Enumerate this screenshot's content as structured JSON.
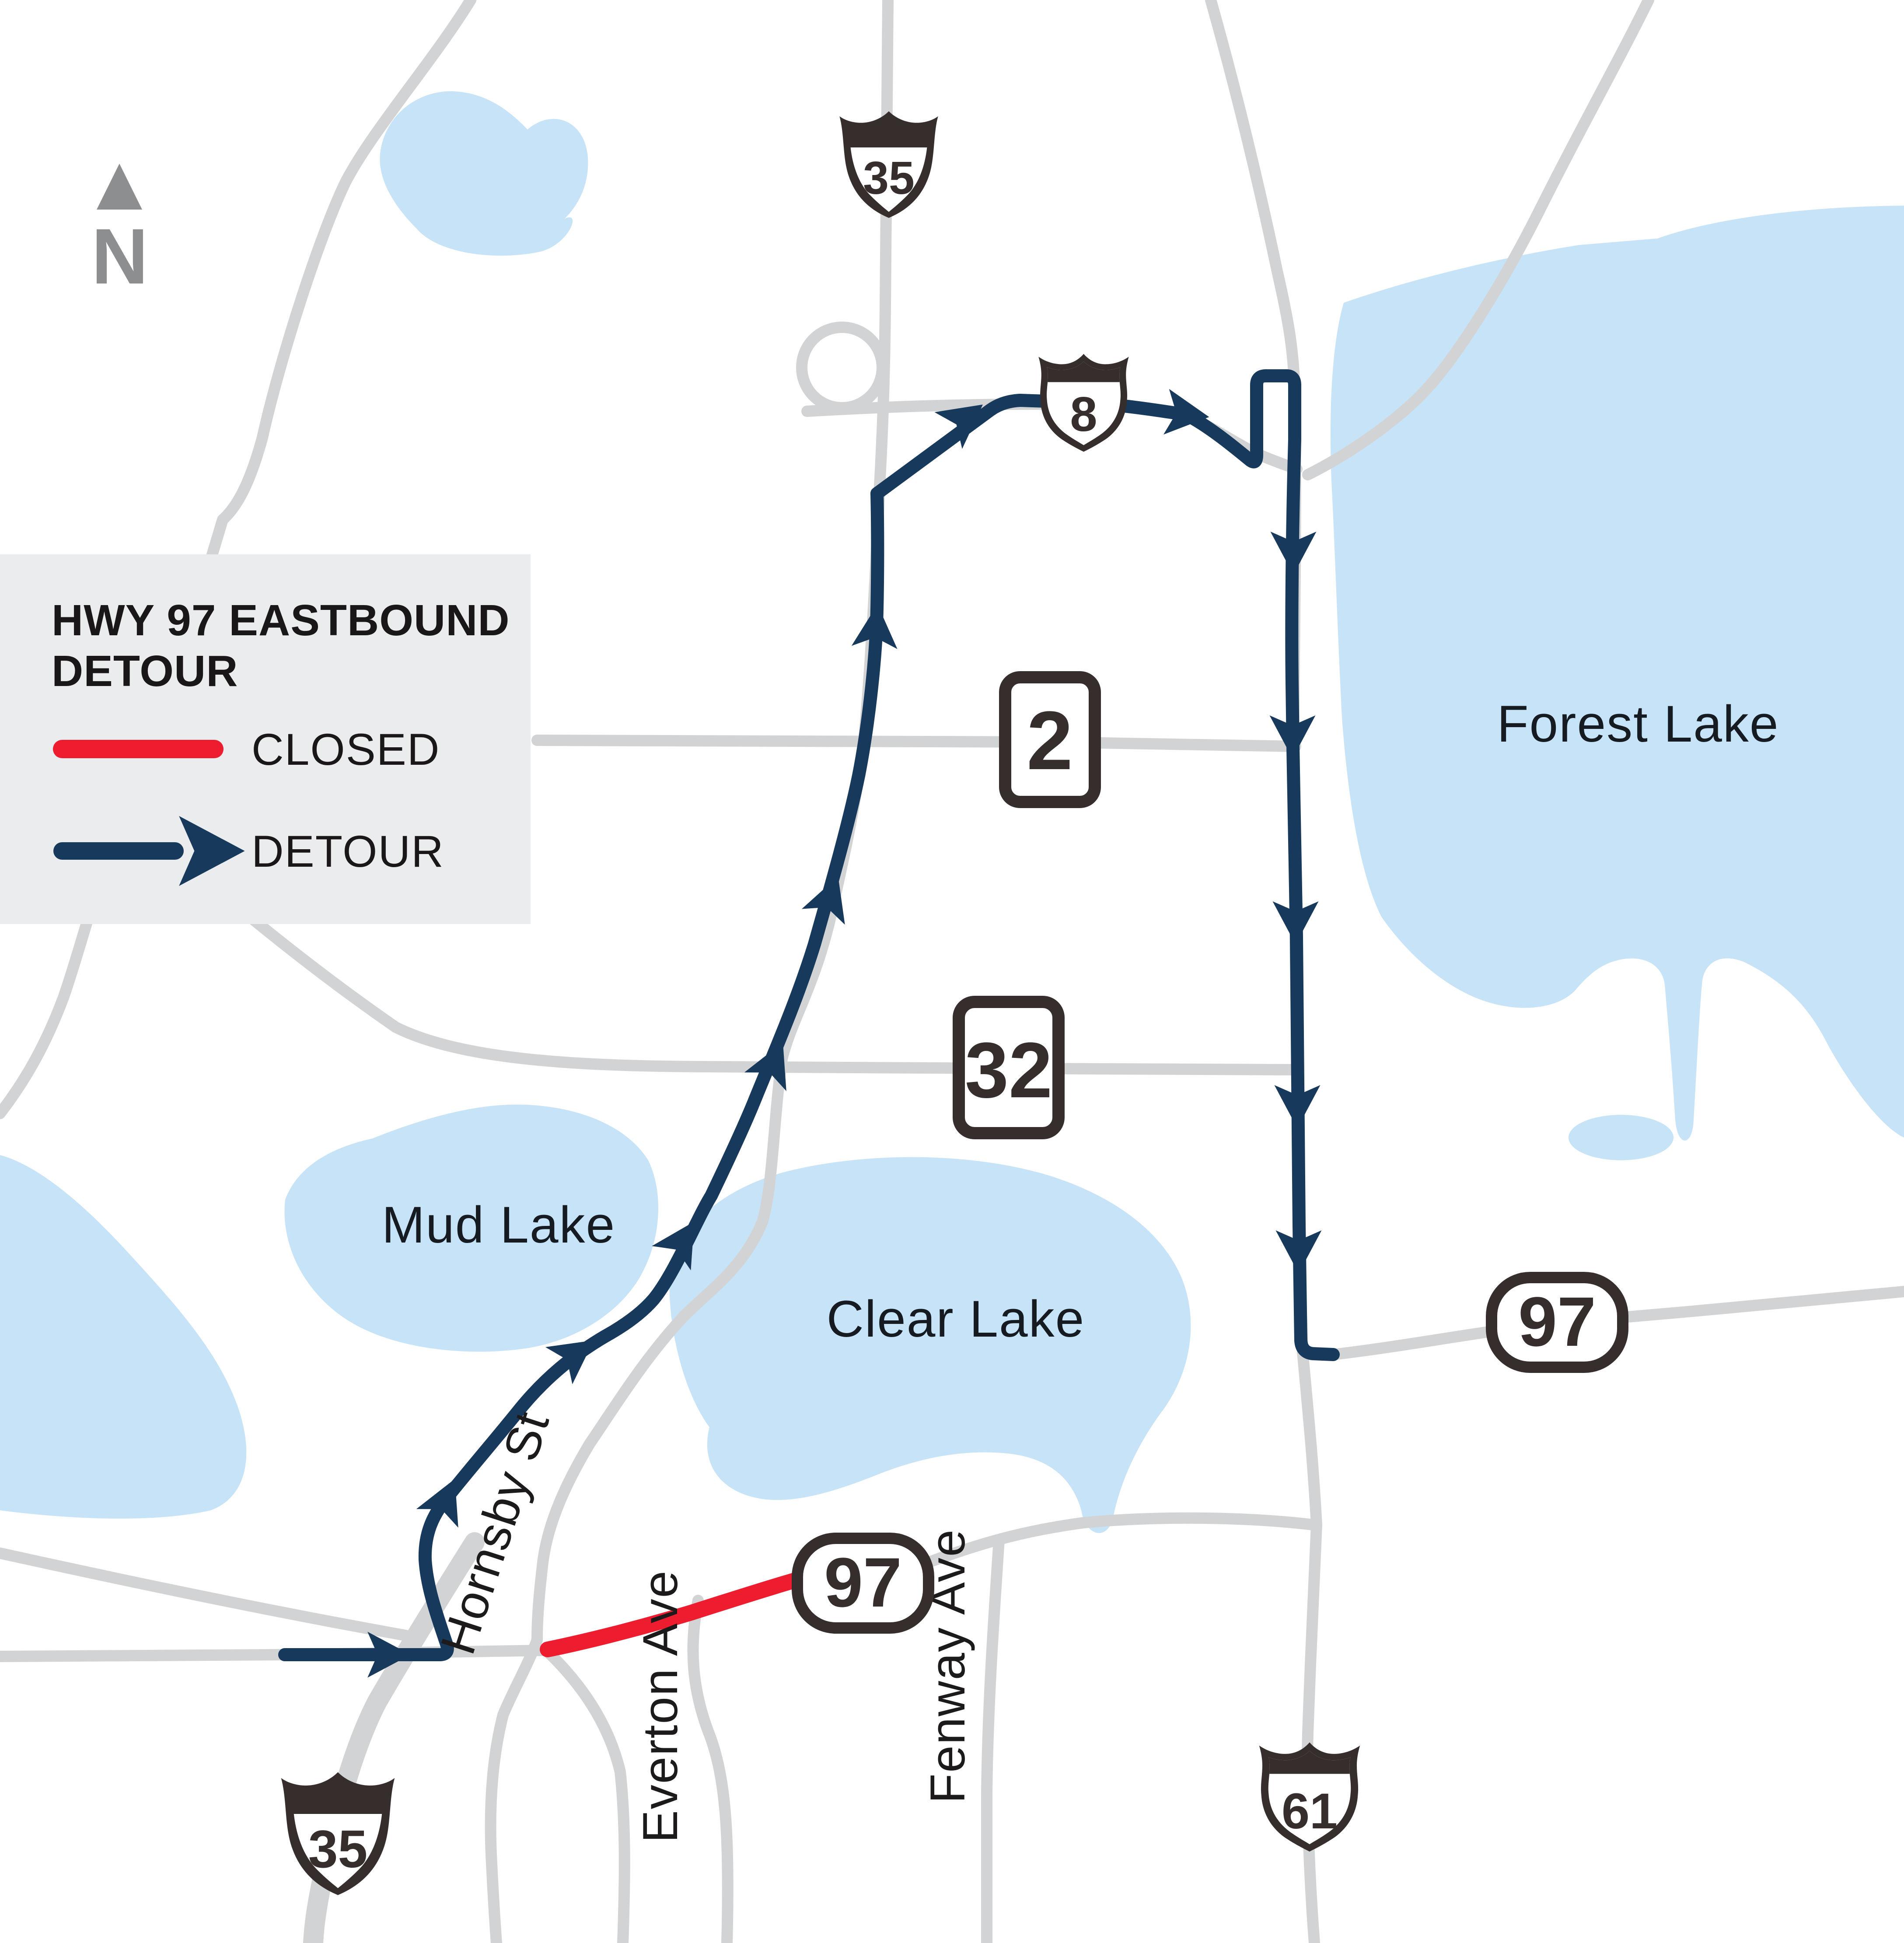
{
  "legend": {
    "title_line1": "HWY 97 EASTBOUND",
    "title_line2": "DETOUR",
    "closed_label": "CLOSED",
    "detour_label": "DETOUR"
  },
  "north": {
    "label": "N"
  },
  "map": {
    "lakes": [
      {
        "name": "Forest Lake"
      },
      {
        "name": "Mud Lake"
      },
      {
        "name": "Clear Lake"
      }
    ],
    "streets": [
      {
        "name": "Hornsby St"
      },
      {
        "name": "Everton Ave"
      },
      {
        "name": "Fenway Ave"
      }
    ],
    "shields": {
      "i35_top": "35",
      "us8": "8",
      "mn2": "2",
      "mn32": "32",
      "mn97_center": "97",
      "mn97_right": "97",
      "us61": "61",
      "i35_bottom": "35"
    }
  },
  "colors": {
    "detour": "#17395c",
    "closed": "#ed1c2e",
    "road": "#d2d3d4",
    "lake": "#c7e3f7",
    "shield_dark": "#362e2d",
    "legend_bg": "#ebeced",
    "north_gray": "#8c8e90"
  }
}
